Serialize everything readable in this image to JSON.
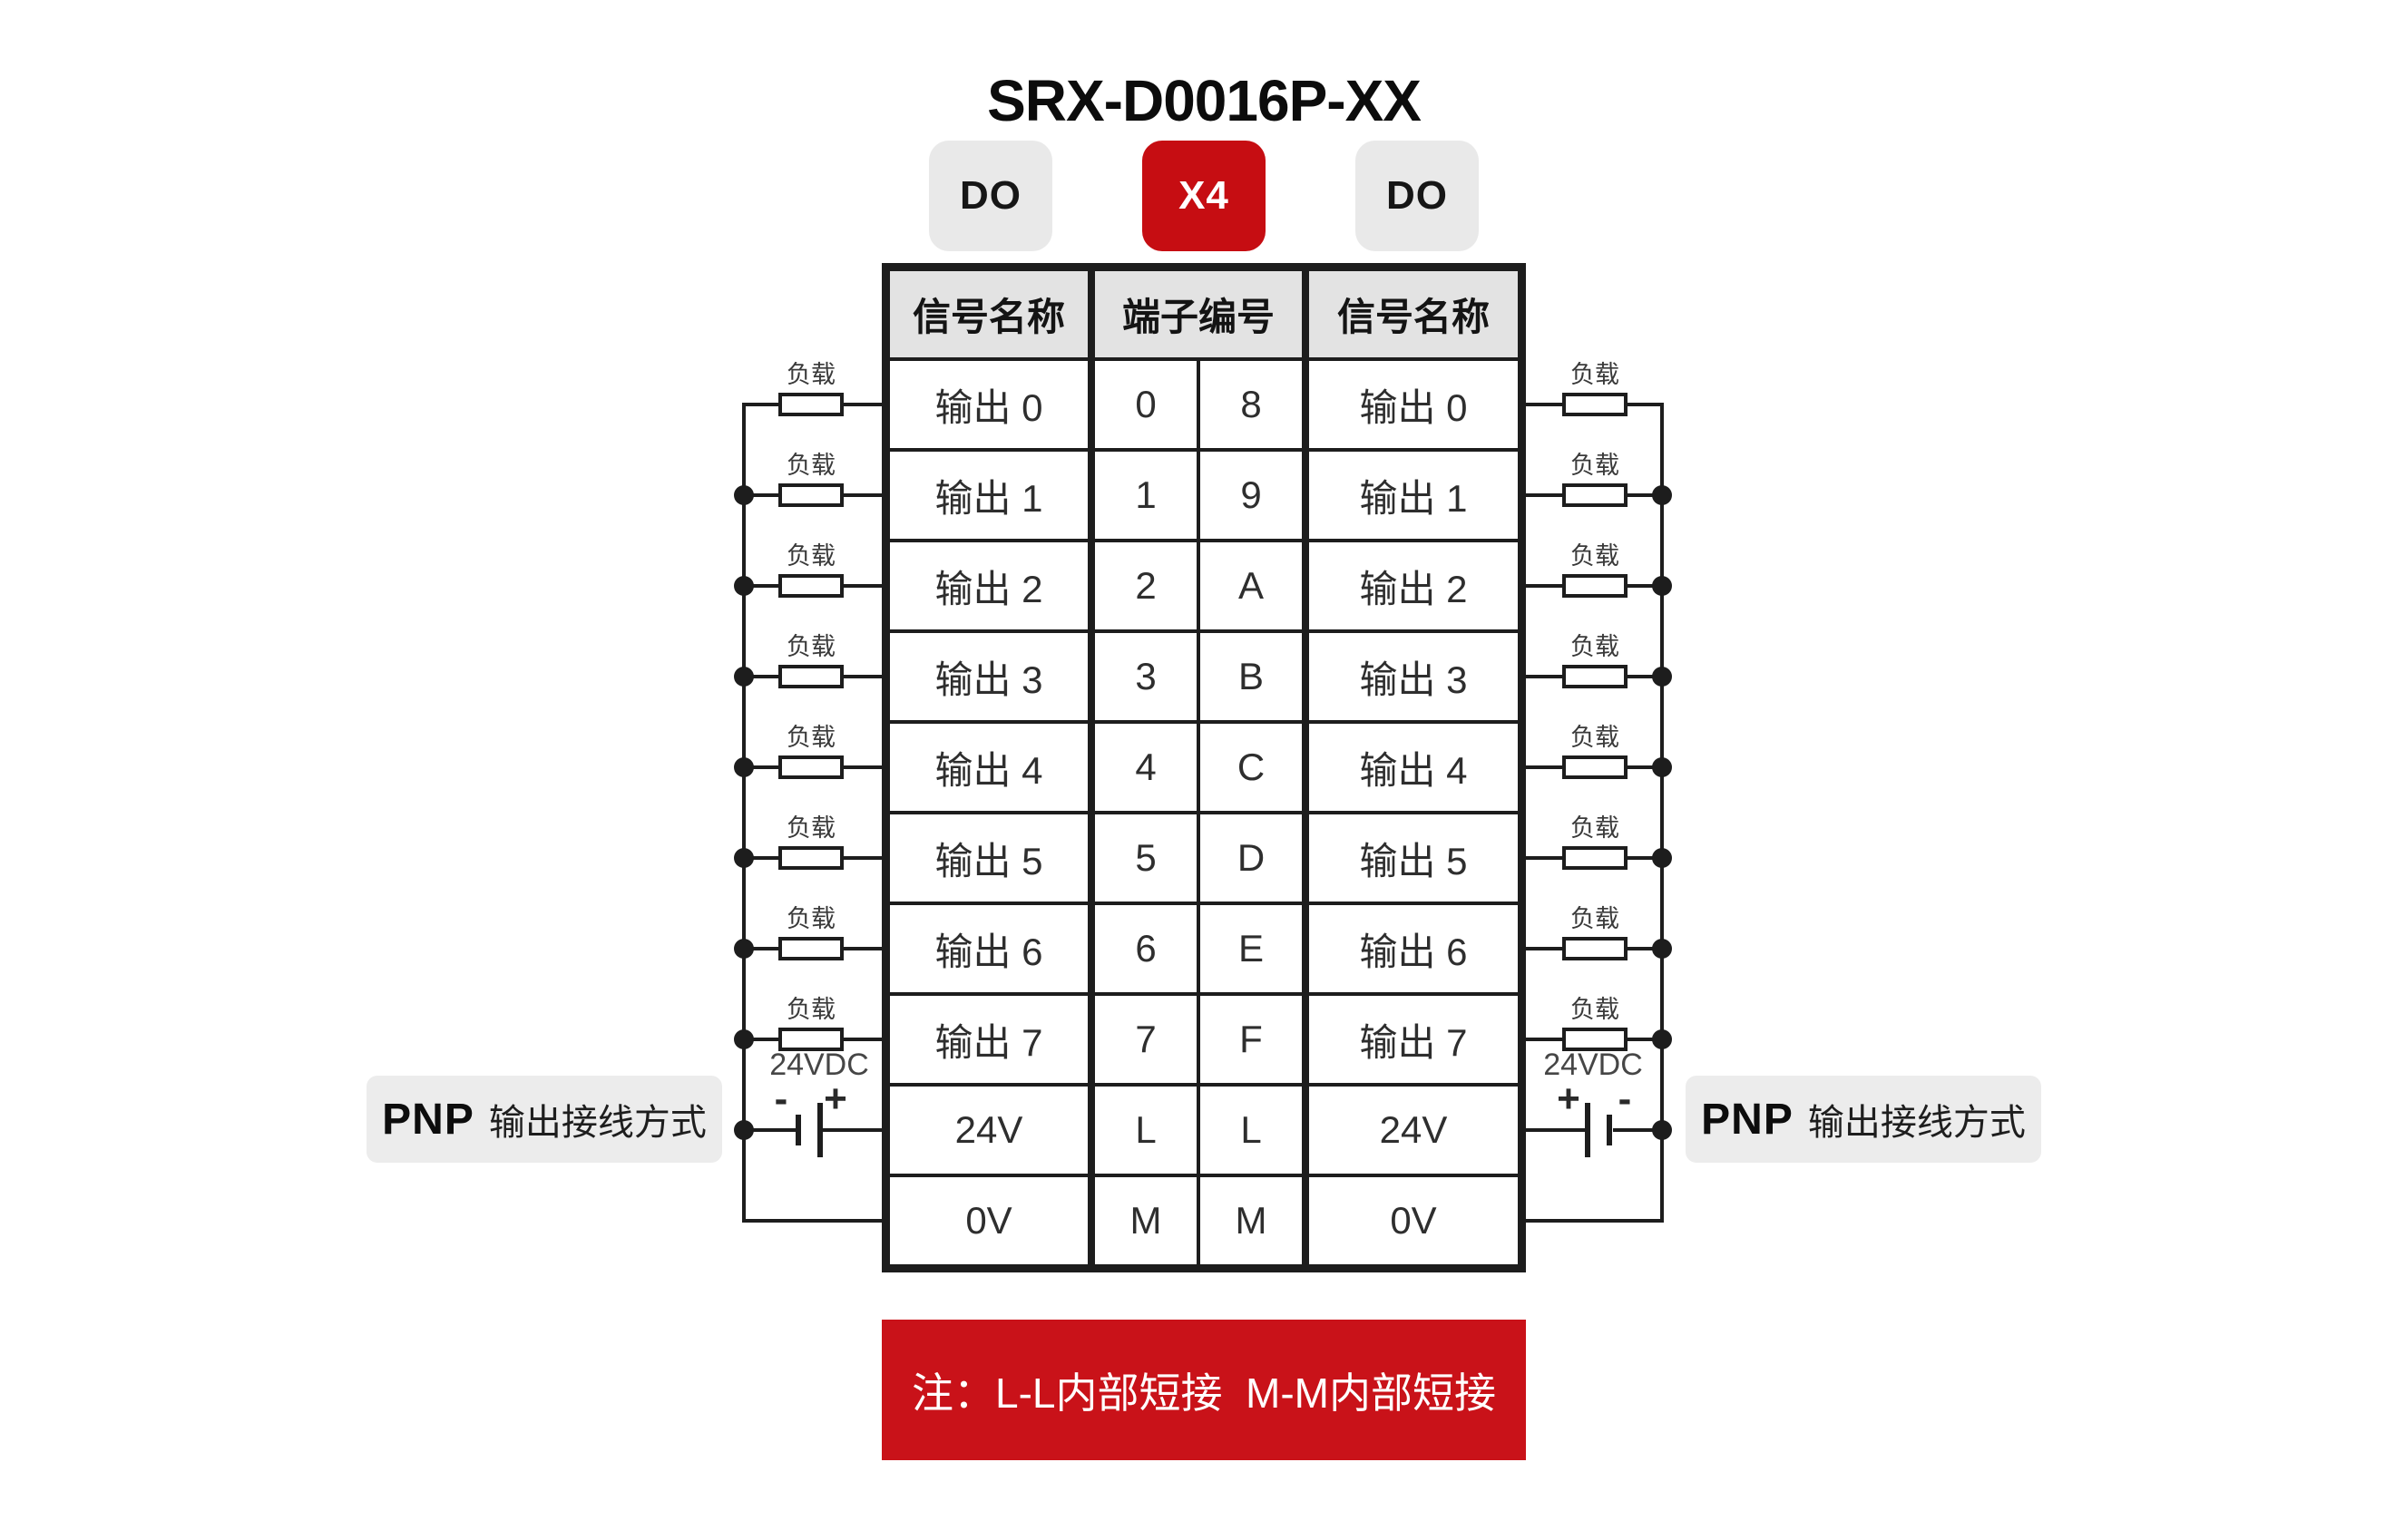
{
  "title": "SRX-D0016P-XX",
  "badges": {
    "left": "DO",
    "center": "X4",
    "right": "DO"
  },
  "table": {
    "header_signal_left": "信号名称",
    "header_terminal": "端子编号",
    "header_signal_right": "信号名称",
    "rows": [
      {
        "left_signal": "输出 0",
        "left_terminal": "0",
        "right_terminal": "8",
        "right_signal": "输出 0"
      },
      {
        "left_signal": "输出 1",
        "left_terminal": "1",
        "right_terminal": "9",
        "right_signal": "输出 1"
      },
      {
        "left_signal": "输出 2",
        "left_terminal": "2",
        "right_terminal": "A",
        "right_signal": "输出 2"
      },
      {
        "left_signal": "输出 3",
        "left_terminal": "3",
        "right_terminal": "B",
        "right_signal": "输出 3"
      },
      {
        "left_signal": "输出 4",
        "left_terminal": "4",
        "right_terminal": "C",
        "right_signal": "输出 4"
      },
      {
        "left_signal": "输出 5",
        "left_terminal": "5",
        "right_terminal": "D",
        "right_signal": "输出 5"
      },
      {
        "left_signal": "输出 6",
        "left_terminal": "6",
        "right_terminal": "E",
        "right_signal": "输出 6"
      },
      {
        "left_signal": "输出 7",
        "left_terminal": "7",
        "right_terminal": "F",
        "right_signal": "输出 7"
      },
      {
        "left_signal": "24V",
        "left_terminal": "L",
        "right_terminal": "L",
        "right_signal": "24V"
      },
      {
        "left_signal": "0V",
        "left_terminal": "M",
        "right_terminal": "M",
        "right_signal": "0V"
      }
    ]
  },
  "circuit": {
    "load_label": "负载",
    "supply_label": "24VDC",
    "minus_sign": "-",
    "plus_sign": "+",
    "wiring_caption_bold": "PNP",
    "wiring_caption_text": "输出接线方式"
  },
  "note": {
    "text": "注：L-L内部短接  M-M内部短接"
  },
  "colors": {
    "badge_red": "#c60d12",
    "banner_red": "#c91219",
    "badge_gray": "#e9e9e9",
    "header_gray": "#e3e3e3",
    "caption_gray": "#ececec",
    "line": "#1d1d1d",
    "cell_text": "#2e2e2e"
  }
}
